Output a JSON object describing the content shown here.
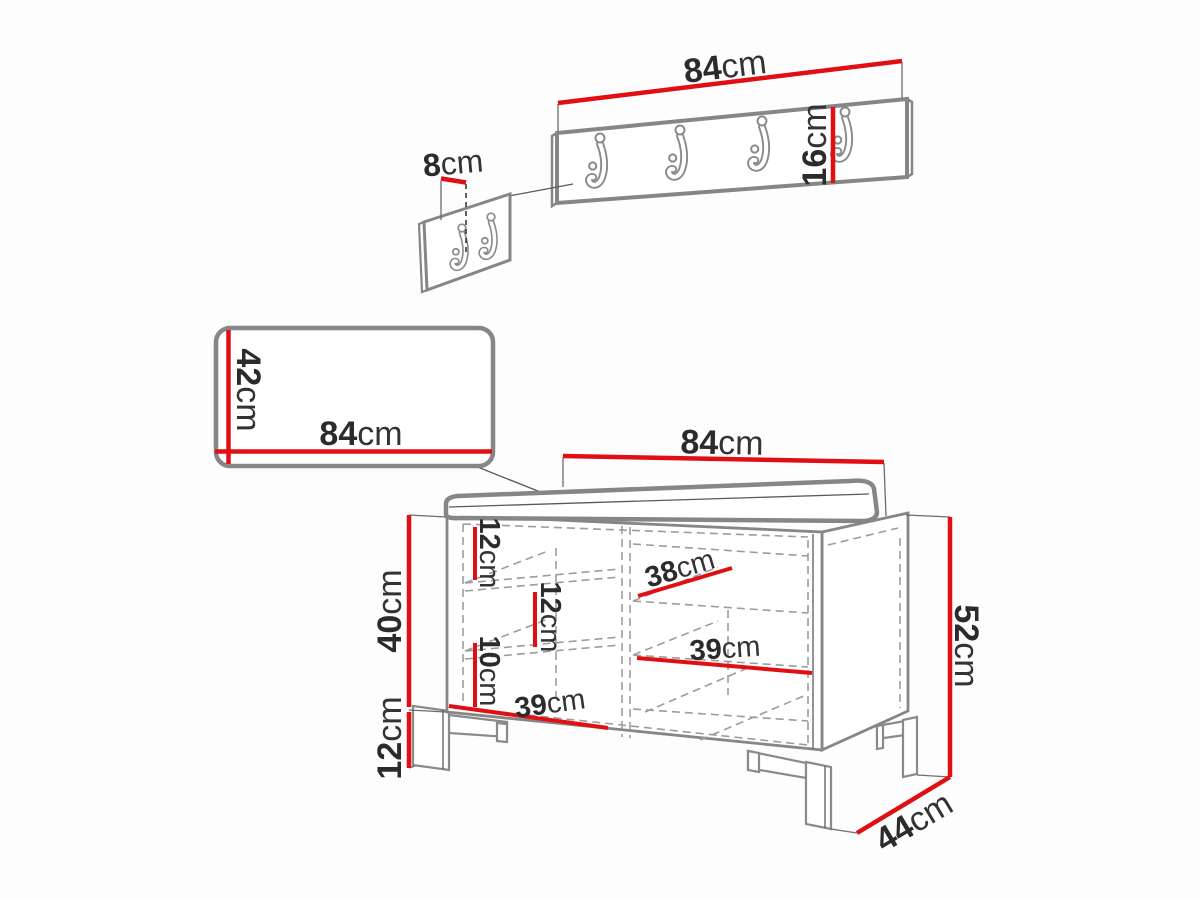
{
  "diagram_title": "hallway furniture set dimensions",
  "colors": {
    "dimension_red": "#e00f14",
    "outline_gray": "#868686",
    "label_text": "#2b2b2b"
  },
  "wall_hanger": {
    "hook_count": 4,
    "width": {
      "num": "84",
      "unit": "cm"
    },
    "height": {
      "num": "16",
      "unit": "cm"
    }
  },
  "hook_detail": {
    "hook_count": 2,
    "spacing": {
      "num": "8",
      "unit": "cm"
    }
  },
  "mirror": {
    "height": {
      "num": "42",
      "unit": "cm"
    },
    "width": {
      "num": "84",
      "unit": "cm"
    }
  },
  "bench": {
    "width": {
      "num": "84",
      "unit": "cm"
    },
    "total_height": {
      "num": "52",
      "unit": "cm"
    },
    "body_height": {
      "num": "40",
      "unit": "cm"
    },
    "leg_height": {
      "num": "12",
      "unit": "cm"
    },
    "depth": {
      "num": "44",
      "unit": "cm"
    },
    "shelves": {
      "gap_top": {
        "num": "12",
        "unit": "cm"
      },
      "gap_mid": {
        "num": "12",
        "unit": "cm"
      },
      "gap_bottom": {
        "num": "10",
        "unit": "cm"
      },
      "width_38": {
        "num": "38",
        "unit": "cm"
      },
      "width_39_right": {
        "num": "39",
        "unit": "cm"
      },
      "width_39_left": {
        "num": "39",
        "unit": "cm"
      }
    }
  }
}
